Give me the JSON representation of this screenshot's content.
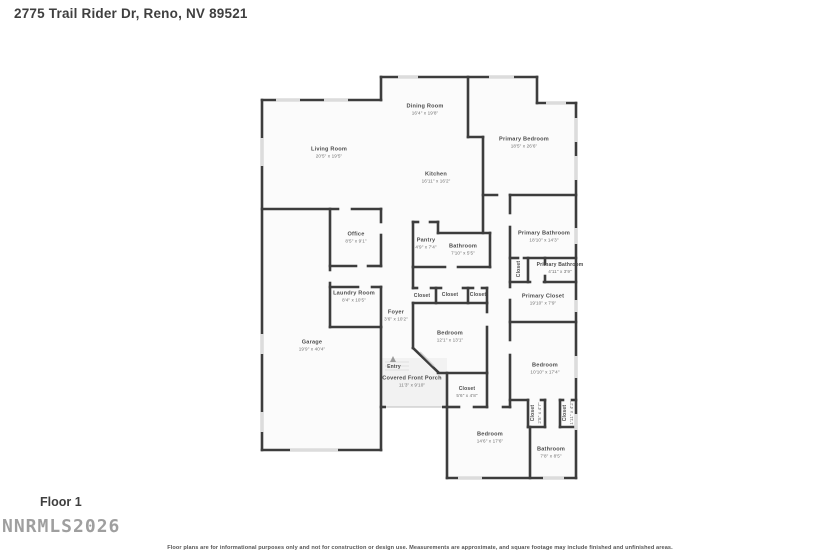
{
  "header": {
    "title": "2775 Trail Rider Dr, Reno, NV 89521"
  },
  "footer": {
    "floor_label": "Floor 1",
    "watermark": "NNRMLS2026",
    "disclaimer": "Floor plans are for informational purposes only and not for construction or design use. Measurements are approximate, and square footage may include finished and unfinished areas."
  },
  "colors": {
    "wall": "#3d3d3d",
    "window": "#dcdcdc",
    "room_fill": "#fbfbfb",
    "porch_fill": "#f2f2f2",
    "door": "#d0d0d0",
    "entry_marker": "#9a9a9a"
  },
  "rooms": [
    {
      "name": "Living Room",
      "dims": "20'5\" x 19'5\""
    },
    {
      "name": "Dining Room",
      "dims": "16'4\" x 19'8\""
    },
    {
      "name": "Kitchen",
      "dims": "16'11\" x 16'2\""
    },
    {
      "name": "Primary Bedroom",
      "dims": "18'5\" x 26'6\""
    },
    {
      "name": "Office",
      "dims": "8'5\" x 9'1\""
    },
    {
      "name": "Pantry",
      "dims": "4'9\" x 7'4\""
    },
    {
      "name": "Bathroom",
      "dims": "7'10\" x 5'5\""
    },
    {
      "name": "Primary Bathroom",
      "dims": "18'10\" x 14'3\""
    },
    {
      "name": "Closet",
      "dims": ""
    },
    {
      "name": "Primary Bathroom",
      "dims": "4'11\" x 3'9\""
    },
    {
      "name": "Primary Closet",
      "dims": "19'10\" x 7'9\""
    },
    {
      "name": "Laundry Room",
      "dims": "8'4\" x 10'5\""
    },
    {
      "name": "Closet",
      "dims": ""
    },
    {
      "name": "Closet",
      "dims": ""
    },
    {
      "name": "Closet",
      "dims": ""
    },
    {
      "name": "Foyer",
      "dims": "3'6\" x 10'2\""
    },
    {
      "name": "Bedroom",
      "dims": "12'1\" x 13'1\""
    },
    {
      "name": "Entry",
      "dims": ""
    },
    {
      "name": "Covered Front Porch",
      "dims": "11'3\" x 9'10\""
    },
    {
      "name": "Garage",
      "dims": "19'9\" x 40'4\""
    },
    {
      "name": "Closet",
      "dims": "5'6\" x 4'8\""
    },
    {
      "name": "Bedroom",
      "dims": "10'10\" x 17'4\""
    },
    {
      "name": "Closet",
      "dims": "2'8\" x 4'7\""
    },
    {
      "name": "Closet",
      "dims": "1'11\" x 4'2\""
    },
    {
      "name": "Bedroom",
      "dims": "14'6\" x 17'6\""
    },
    {
      "name": "Bathroom",
      "dims": "7'8\" x 8'5\""
    }
  ]
}
